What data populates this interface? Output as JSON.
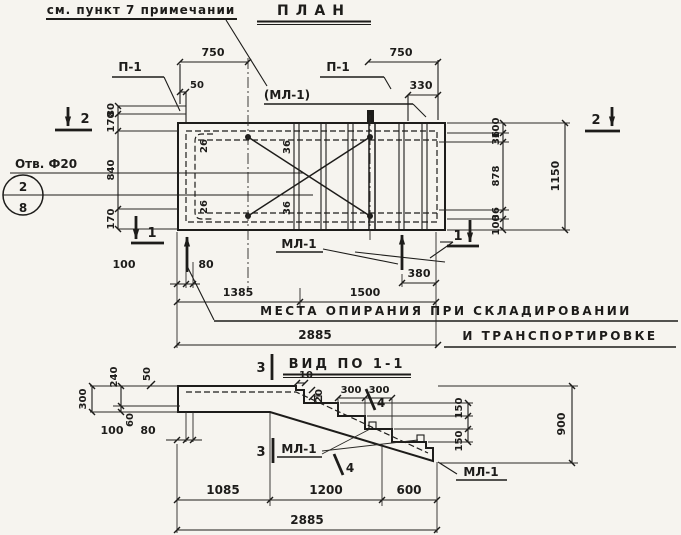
{
  "colors": {
    "ink": "#1d1c1a",
    "paper": "#f6f4ef"
  },
  "note": "см. пункт 7 примечании",
  "plan": {
    "title": "ПЛАН",
    "labels": {
      "p1_left": "П-1",
      "p1_right": "П-1",
      "ml1_paren": "(МЛ-1)",
      "ml1_support": "МЛ-1",
      "hole_note": "Отв. Ф20",
      "hole_pos_num": "2",
      "hole_pos_den": "8",
      "bar26_top": "26",
      "bar26_bottom": "26",
      "bar36_top": "36",
      "bar36_bottom": "36"
    },
    "dims": {
      "top_left_750": "750",
      "top_right_750": "750",
      "edge_50": "50",
      "right_330": "330",
      "left_80": "80",
      "left_170_upper": "170",
      "left_840": "840",
      "left_170_lower": "170",
      "right_100_top": "100",
      "right_36_top": "36",
      "right_878": "878",
      "right_36_bottom": "36",
      "right_100_bottom": "100",
      "overall_height_1150": "1150",
      "bottom_100": "100",
      "bottom_80": "80",
      "bottom_1385": "1385",
      "bottom_1500": "1500",
      "bottom_380": "380",
      "overall_width_2885": "2885"
    },
    "markers": {
      "section_2": "2",
      "section_1": "1"
    },
    "support_note_line1": "МЕСТА ОПИРАНИЯ ПРИ СКЛАДИРОВАНИИ",
    "support_note_line2": "И ТРАНСПОРТИРОВКЕ"
  },
  "section": {
    "title": "ВИД ПО 1-1",
    "labels": {
      "ml1_steps": "МЛ-1",
      "ml1_end": "МЛ-1"
    },
    "markers": {
      "section_3": "3",
      "pos_4": "4"
    },
    "dims": {
      "left_300": "300",
      "left_240": "240",
      "left_50": "50",
      "left_60": "60",
      "left_100": "100",
      "left_80": "80",
      "notch_10": "10",
      "notch_20": "20",
      "tread_300_a": "300",
      "tread_300_b": "300",
      "riser_150_a": "150",
      "riser_150_b": "150",
      "right_900": "900",
      "bottom_1085": "1085",
      "bottom_1200": "1200",
      "bottom_600": "600",
      "overall_2885": "2885"
    }
  }
}
